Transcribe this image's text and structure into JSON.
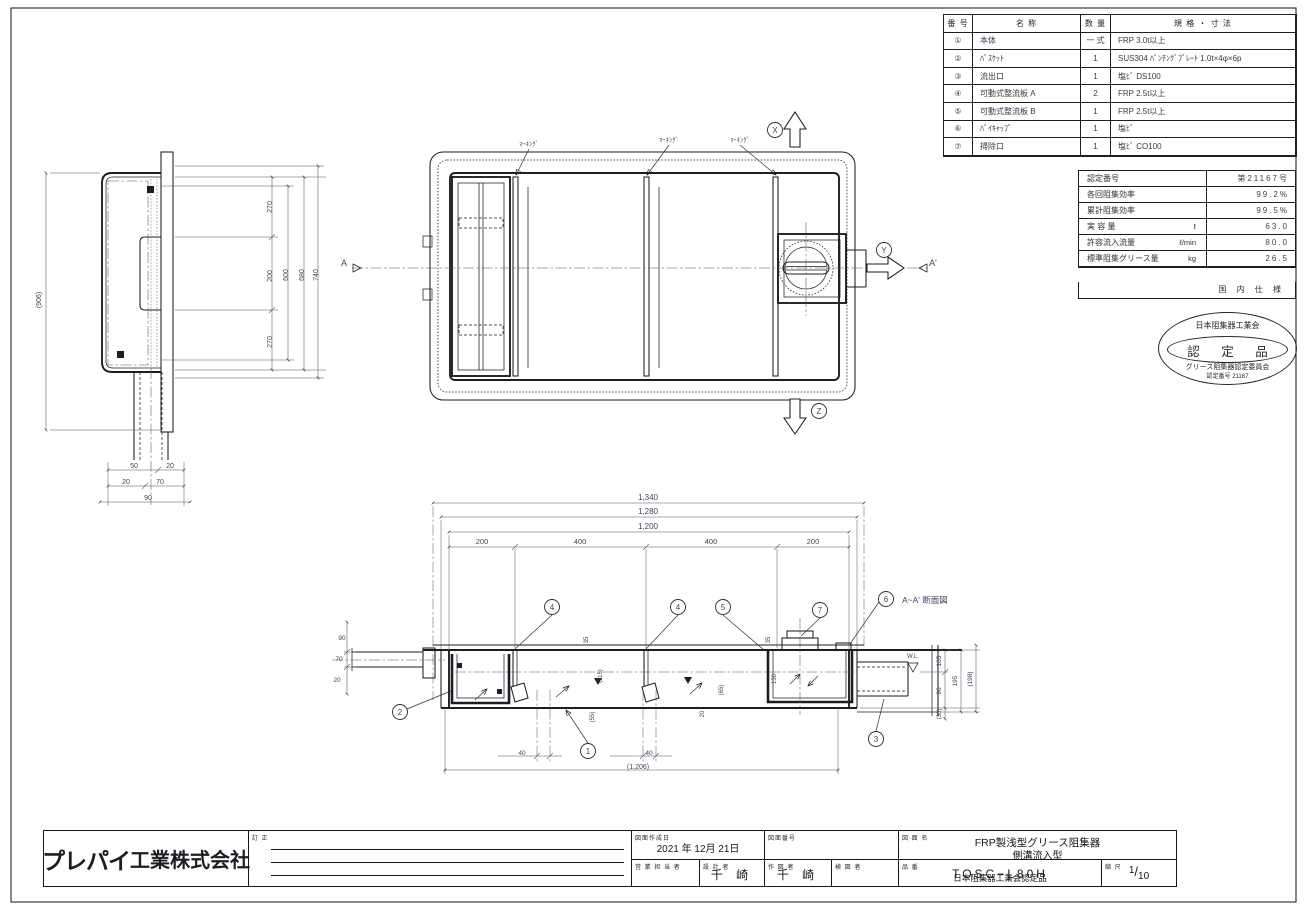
{
  "parts_table": {
    "headers": {
      "no": "番 号",
      "name": "名   称",
      "qty": "数 量",
      "spec": "規 格 ・ 寸 法"
    },
    "rows": [
      {
        "no": "①",
        "name": "本体",
        "qty": "一 式",
        "spec": "FRP 3.0t以上"
      },
      {
        "no": "②",
        "name": "ﾊﾞｽｹｯﾄ",
        "qty": "1",
        "spec": "SUS304 ﾊﾟﾝﾁﾝｸﾞﾌﾟﾚｰﾄ 1.0t×4φ×6p"
      },
      {
        "no": "③",
        "name": "流出口",
        "qty": "1",
        "spec": "塩ﾋﾞ DS100"
      },
      {
        "no": "④",
        "name": "可動式整流板 A",
        "qty": "2",
        "spec": "FRP 2.5t以上"
      },
      {
        "no": "⑤",
        "name": "可動式整流板 B",
        "qty": "1",
        "spec": "FRP 2.5t以上"
      },
      {
        "no": "⑥",
        "name": "ﾊﾟｲｷｬｯﾌﾟ",
        "qty": "1",
        "spec": "塩ﾋﾞ"
      },
      {
        "no": "⑦",
        "name": "掃除口",
        "qty": "1",
        "spec": "塩ﾋﾞ CO100"
      }
    ]
  },
  "spec_table": {
    "rows": [
      {
        "label": "認定番号",
        "unit": "",
        "value": "第21167号"
      },
      {
        "label": "各回阻集効率",
        "unit": "",
        "value": "99.2%"
      },
      {
        "label": "累計阻集効率",
        "unit": "",
        "value": "99.5%"
      },
      {
        "label": "実 容 量",
        "unit": "ℓ",
        "value": "63.0"
      },
      {
        "label": "許容流入流量",
        "unit": "ℓ/min",
        "value": "80.0"
      },
      {
        "label": "標準阻集グリース量",
        "unit": "kg",
        "value": "26.5"
      }
    ],
    "footer": "国 内 仕 様"
  },
  "stamp": {
    "org": "日本阻集器工業会",
    "title": "認 定 品",
    "committee": "グリース阻集器認定委員会",
    "number": "認定番号 21167"
  },
  "title_block": {
    "company_logo": "プレパイ",
    "company_suffix": "工業株式会社",
    "revision_label": "訂 正",
    "date_label": "図面作成日",
    "date_value": "2021 年 12月 21日",
    "drawing_no_label": "図面番号",
    "drawing_name_label": "図 面 名",
    "drawing_name_line1": "FRP製浅型グリース阻集器",
    "drawing_name_line2": "側溝流入型",
    "sales_label": "営 業 担 当 者",
    "designer_label": "設 計 者",
    "designer_value": "千  崎",
    "drafter_label": "作 図 者",
    "drafter_value": "千  崎",
    "checker_label": "検 図 者",
    "product_label": "品 番",
    "product_no": "TOSC−L80H",
    "product_note": "日本阻集器工業会認定品",
    "scale_label": "縮 尺",
    "scale_numerator": "1",
    "scale_denominator": "10"
  },
  "drawing_labels": [
    {
      "name": "marking-label-1",
      "text": "ﾏｰｷﾝｸﾞ",
      "x": 529,
      "y": 146,
      "size": 6.5
    },
    {
      "name": "marking-label-2",
      "text": "ﾏｰｷﾝｸﾞ",
      "x": 669,
      "y": 142,
      "size": 6.5
    },
    {
      "name": "marking-label-3",
      "text": "ﾏｰｷﾝｸﾞ",
      "x": 740,
      "y": 142,
      "size": 6.5
    },
    {
      "name": "axis-x-balloon",
      "text": "X",
      "x": 775,
      "y": 130,
      "balloon": true,
      "size": 8
    },
    {
      "name": "axis-y-balloon",
      "text": "Y",
      "x": 884,
      "y": 250,
      "balloon": true,
      "size": 8
    },
    {
      "name": "axis-z-balloon",
      "text": "Z",
      "x": 819,
      "y": 411,
      "balloon": true,
      "size": 8
    },
    {
      "name": "section-mark-a",
      "text": "A",
      "x": 344,
      "y": 266,
      "size": 9
    },
    {
      "name": "section-mark-a-prime",
      "text": "A'",
      "x": 933,
      "y": 266,
      "size": 9
    },
    {
      "name": "side-dim-overall",
      "text": "(906)",
      "x": 41,
      "y": 300,
      "size": 7,
      "rotate": -90
    },
    {
      "name": "side-dim-270a",
      "text": "270",
      "x": 272,
      "y": 207,
      "size": 7,
      "rotate": -90
    },
    {
      "name": "side-dim-200",
      "text": "200",
      "x": 272,
      "y": 276,
      "size": 7,
      "rotate": -90
    },
    {
      "name": "side-dim-270b",
      "text": "270",
      "x": 272,
      "y": 342,
      "size": 7,
      "rotate": -90
    },
    {
      "name": "side-dim-600",
      "text": "600",
      "x": 288,
      "y": 275,
      "size": 7,
      "rotate": -90
    },
    {
      "name": "side-dim-680",
      "text": "680",
      "x": 304,
      "y": 275,
      "size": 7,
      "rotate": -90
    },
    {
      "name": "side-dim-740",
      "text": "740",
      "x": 318,
      "y": 275,
      "size": 7,
      "rotate": -90
    },
    {
      "name": "side-dim-50",
      "text": "50",
      "x": 134,
      "y": 468,
      "size": 7
    },
    {
      "name": "side-dim-20a",
      "text": "20",
      "x": 170,
      "y": 468,
      "size": 7
    },
    {
      "name": "side-dim-20b",
      "text": "20",
      "x": 126,
      "y": 484,
      "size": 7
    },
    {
      "name": "side-dim-70",
      "text": "70",
      "x": 160,
      "y": 484,
      "size": 7
    },
    {
      "name": "side-dim-90",
      "text": "90",
      "x": 148,
      "y": 500,
      "size": 7
    },
    {
      "name": "sec-dim-1340",
      "text": "1,340",
      "x": 648,
      "y": 500,
      "size": 8
    },
    {
      "name": "sec-dim-1280",
      "text": "1,280",
      "x": 648,
      "y": 514,
      "size": 8
    },
    {
      "name": "sec-dim-1200",
      "text": "1,200",
      "x": 648,
      "y": 529,
      "size": 8
    },
    {
      "name": "sec-dim-200a",
      "text": "200",
      "x": 482,
      "y": 544,
      "size": 7.5
    },
    {
      "name": "sec-dim-400a",
      "text": "400",
      "x": 580,
      "y": 544,
      "size": 7.5
    },
    {
      "name": "sec-dim-400b",
      "text": "400",
      "x": 711,
      "y": 544,
      "size": 7.5
    },
    {
      "name": "sec-dim-200b",
      "text": "200",
      "x": 813,
      "y": 544,
      "size": 7.5
    },
    {
      "name": "balloon-2",
      "text": "2",
      "x": 400,
      "y": 712,
      "balloon": true,
      "size": 8
    },
    {
      "name": "balloon-4a",
      "text": "4",
      "x": 552,
      "y": 607,
      "balloon": true,
      "size": 8
    },
    {
      "name": "balloon-4b",
      "text": "4",
      "x": 678,
      "y": 607,
      "balloon": true,
      "size": 8
    },
    {
      "name": "balloon-5",
      "text": "5",
      "x": 723,
      "y": 607,
      "balloon": true,
      "size": 8
    },
    {
      "name": "balloon-7",
      "text": "7",
      "x": 820,
      "y": 610,
      "balloon": true,
      "size": 8
    },
    {
      "name": "balloon-6",
      "text": "6",
      "x": 886,
      "y": 599,
      "balloon": true,
      "size": 8
    },
    {
      "name": "balloon-1",
      "text": "1",
      "x": 588,
      "y": 751,
      "balloon": true,
      "size": 8
    },
    {
      "name": "balloon-3",
      "text": "3",
      "x": 876,
      "y": 739,
      "balloon": true,
      "size": 8
    },
    {
      "name": "section-title",
      "text": "A~A' 断面図",
      "x": 902,
      "y": 603,
      "size": 8.5,
      "anchor": "start"
    },
    {
      "name": "water-level-label",
      "text": "W.L.",
      "x": 913,
      "y": 658,
      "size": 6
    },
    {
      "name": "sec-dim-105",
      "text": "105",
      "x": 941,
      "y": 661,
      "size": 6.5,
      "rotate": -90
    },
    {
      "name": "sec-dim-90r",
      "text": "90",
      "x": 941,
      "y": 691,
      "size": 6.5,
      "rotate": -90
    },
    {
      "name": "sec-dim-195",
      "text": "195",
      "x": 957,
      "y": 681,
      "size": 6.5,
      "rotate": -90
    },
    {
      "name": "sec-dim-198",
      "text": "(198)",
      "x": 972,
      "y": 679,
      "size": 6.5,
      "rotate": -90
    },
    {
      "name": "sec-dim-30",
      "text": "(30)",
      "x": 941,
      "y": 714,
      "size": 6,
      "rotate": -90
    },
    {
      "name": "sec-dim-90l",
      "text": "90",
      "x": 342,
      "y": 640,
      "size": 6.5
    },
    {
      "name": "sec-dim-70l",
      "text": "70",
      "x": 339,
      "y": 661,
      "size": 6.5
    },
    {
      "name": "sec-dim-20l",
      "text": "20",
      "x": 337,
      "y": 682,
      "size": 6.5
    },
    {
      "name": "sec-dim-35a",
      "text": "35",
      "x": 588,
      "y": 640,
      "size": 6,
      "rotate": -90
    },
    {
      "name": "sec-dim-115",
      "text": "(115)",
      "x": 602,
      "y": 676,
      "size": 6,
      "rotate": -90
    },
    {
      "name": "sec-dim-55",
      "text": "(55)",
      "x": 594,
      "y": 717,
      "size": 6,
      "rotate": -90
    },
    {
      "name": "sec-dim-35b",
      "text": "35",
      "x": 770,
      "y": 640,
      "size": 6,
      "rotate": -90
    },
    {
      "name": "sec-dim-150",
      "text": "150",
      "x": 776,
      "y": 679,
      "size": 6,
      "rotate": -90
    },
    {
      "name": "sec-dim-65",
      "text": "(65)",
      "x": 723,
      "y": 690,
      "size": 6,
      "rotate": -90
    },
    {
      "name": "sec-dim-20m",
      "text": "20",
      "x": 704,
      "y": 714,
      "size": 6,
      "rotate": -90
    },
    {
      "name": "sec-dim-40a",
      "text": "40",
      "x": 522,
      "y": 755,
      "size": 6.5
    },
    {
      "name": "sec-dim-40b",
      "text": "40",
      "x": 649,
      "y": 755,
      "size": 6.5
    },
    {
      "name": "sec-dim-1206",
      "text": "(1,206)",
      "x": 638,
      "y": 769,
      "size": 7
    }
  ]
}
